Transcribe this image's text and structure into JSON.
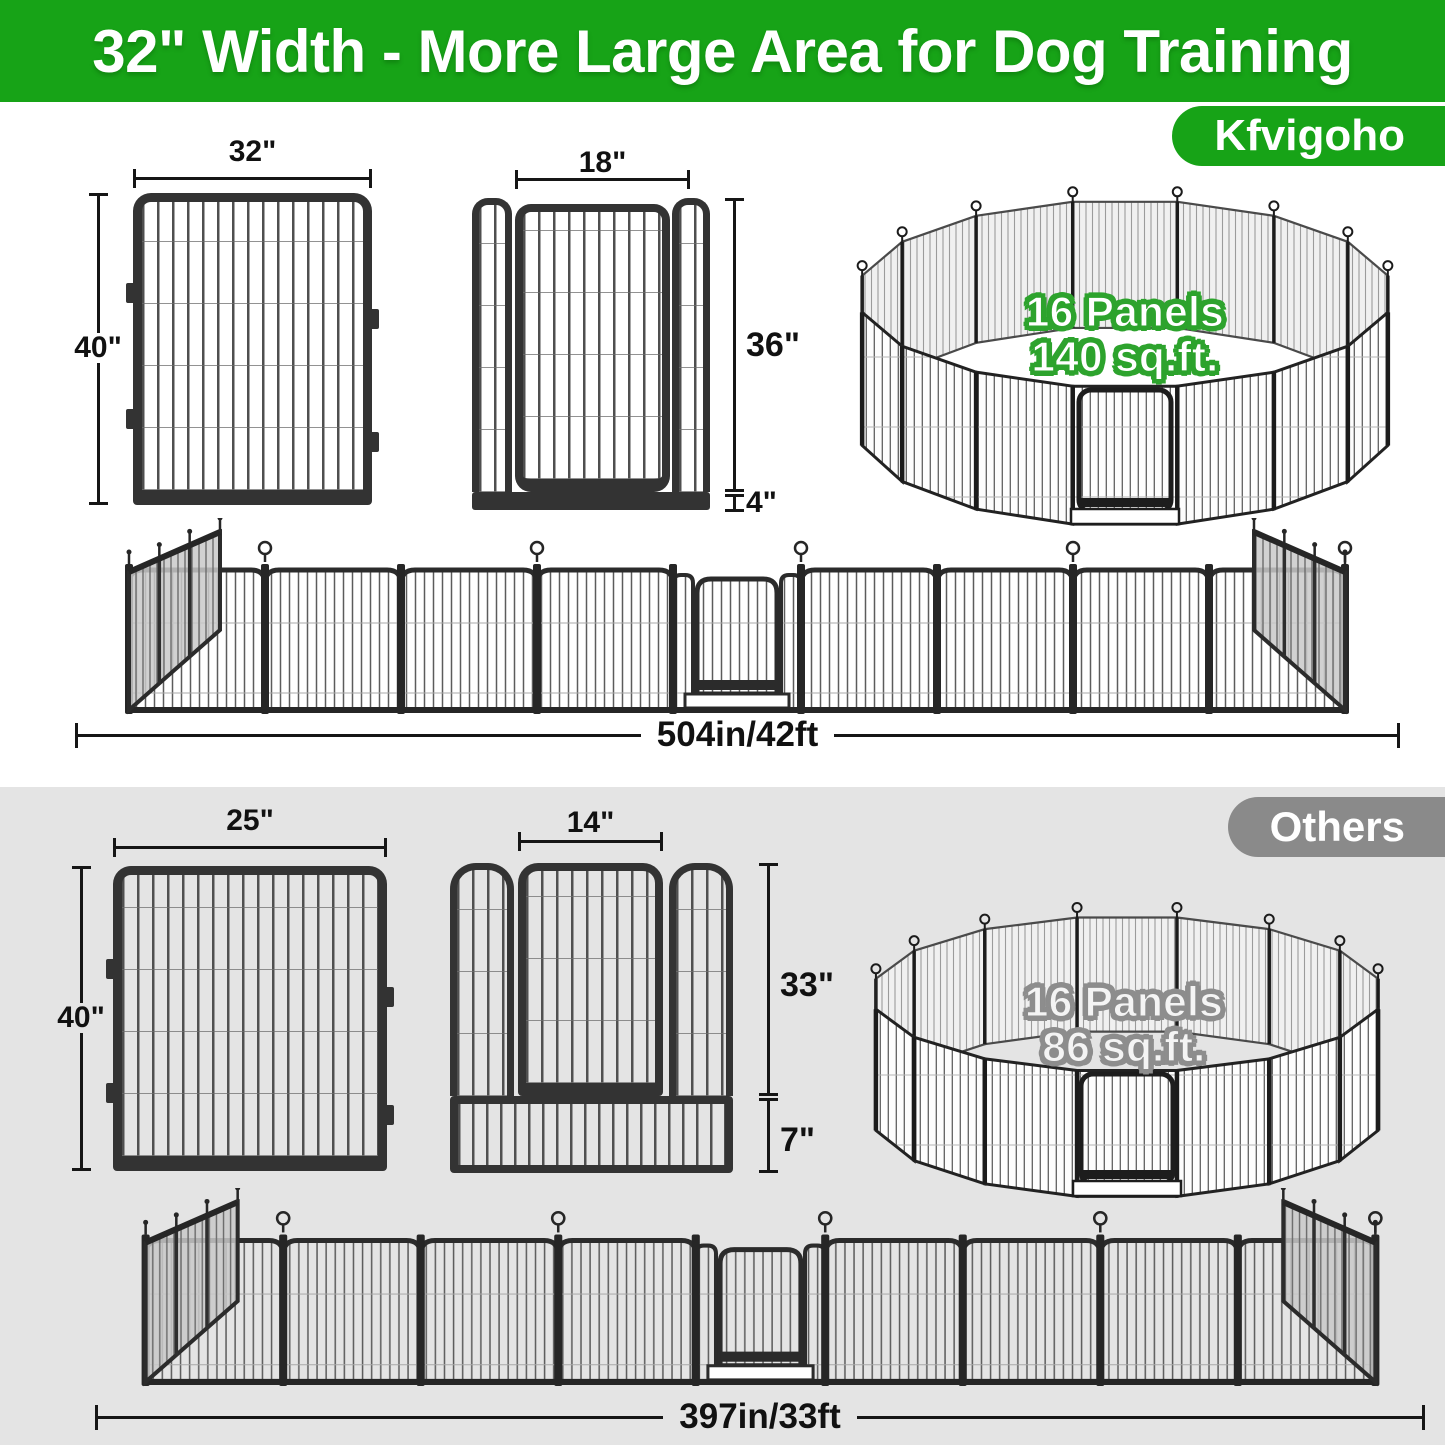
{
  "banner": {
    "title": "32\" Width - More Large Area for Dog Training"
  },
  "kfvigoho": {
    "badge": "Kfvigoho",
    "panel": {
      "width_label": "32\"",
      "height_label": "40\""
    },
    "door_panel": {
      "width_label": "18\"",
      "door_height_label": "36\"",
      "bottom_height_label": "4\""
    },
    "pen": {
      "line1": "16 Panels",
      "line2": "140 sq.ft."
    },
    "total_length": "504in/42ft"
  },
  "others": {
    "badge": "Others",
    "panel": {
      "width_label": "25\"",
      "height_label": "40\""
    },
    "door_panel": {
      "width_label": "14\"",
      "door_height_label": "33\"",
      "bottom_height_label": "7\""
    },
    "pen": {
      "line1": "16 Panels",
      "line2": "86 sq.ft."
    },
    "total_length": "397in/33ft"
  },
  "colors": {
    "brand_green": "#17a317",
    "others_gray": "#8a8a8a",
    "section_gray": "#e4e4e4",
    "frame_dark": "#333333",
    "pen_text_outline_green": "#2da32d",
    "pen_text_outline_gray": "#8d8d8d"
  }
}
